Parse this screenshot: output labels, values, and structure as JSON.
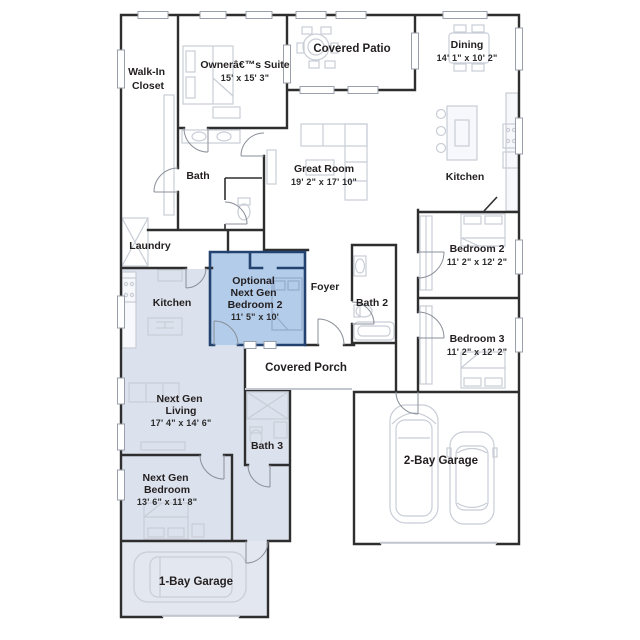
{
  "plan": {
    "type": "single-story floor plan with next gen suite",
    "colors": {
      "wall": "#2e2e2e",
      "optional_room_fill": "#b3cce9",
      "optional_room_wall": "#24426f",
      "next_gen_fill": "#dce2ed",
      "garage_fill": "#e3e7ef",
      "furniture": "#c8cdd6",
      "text": "#231f20",
      "window": "#9aa0ab"
    },
    "rooms": [
      {
        "id": "walk-in-closet",
        "lines": [
          "Walk-In",
          "Closet"
        ]
      },
      {
        "id": "owners-suite",
        "lines": [
          "Ownerâ€™s Suite"
        ],
        "dims": "15' x 15' 3\""
      },
      {
        "id": "covered-patio",
        "lines": [
          "Covered Patio"
        ]
      },
      {
        "id": "dining",
        "lines": [
          "Dining"
        ],
        "dims": "14' 1\" x 10' 2\""
      },
      {
        "id": "great-room",
        "lines": [
          "Great Room"
        ],
        "dims": "19' 2\" x 17' 10\""
      },
      {
        "id": "kitchen",
        "lines": [
          "Kitchen"
        ]
      },
      {
        "id": "bath",
        "lines": [
          "Bath"
        ]
      },
      {
        "id": "laundry",
        "lines": [
          "Laundry"
        ]
      },
      {
        "id": "bedroom-2",
        "lines": [
          "Bedroom 2"
        ],
        "dims": "11' 2\" x 12' 2\""
      },
      {
        "id": "bedroom-3",
        "lines": [
          "Bedroom 3"
        ],
        "dims": "11' 2\" x 12' 2\""
      },
      {
        "id": "optional-next-gen-bedroom-2",
        "lines": [
          "Optional",
          "Next Gen",
          "Bedroom 2"
        ],
        "dims": "11' 5\" x 10'"
      },
      {
        "id": "foyer",
        "lines": [
          "Foyer"
        ]
      },
      {
        "id": "bath-2",
        "lines": [
          "Bath 2"
        ]
      },
      {
        "id": "covered-porch",
        "lines": [
          "Covered Porch"
        ]
      },
      {
        "id": "next-gen-kitchen",
        "lines": [
          "Kitchen"
        ]
      },
      {
        "id": "next-gen-living",
        "lines": [
          "Next Gen",
          "Living"
        ],
        "dims": "17' 4\" x 14' 6\""
      },
      {
        "id": "bath-3",
        "lines": [
          "Bath 3"
        ]
      },
      {
        "id": "next-gen-bedroom",
        "lines": [
          "Next Gen",
          "Bedroom"
        ],
        "dims": "13' 6\" x 11' 8\""
      },
      {
        "id": "one-bay-garage",
        "lines": [
          "1-Bay Garage"
        ]
      },
      {
        "id": "two-bay-garage",
        "lines": [
          "2-Bay Garage"
        ]
      }
    ]
  }
}
